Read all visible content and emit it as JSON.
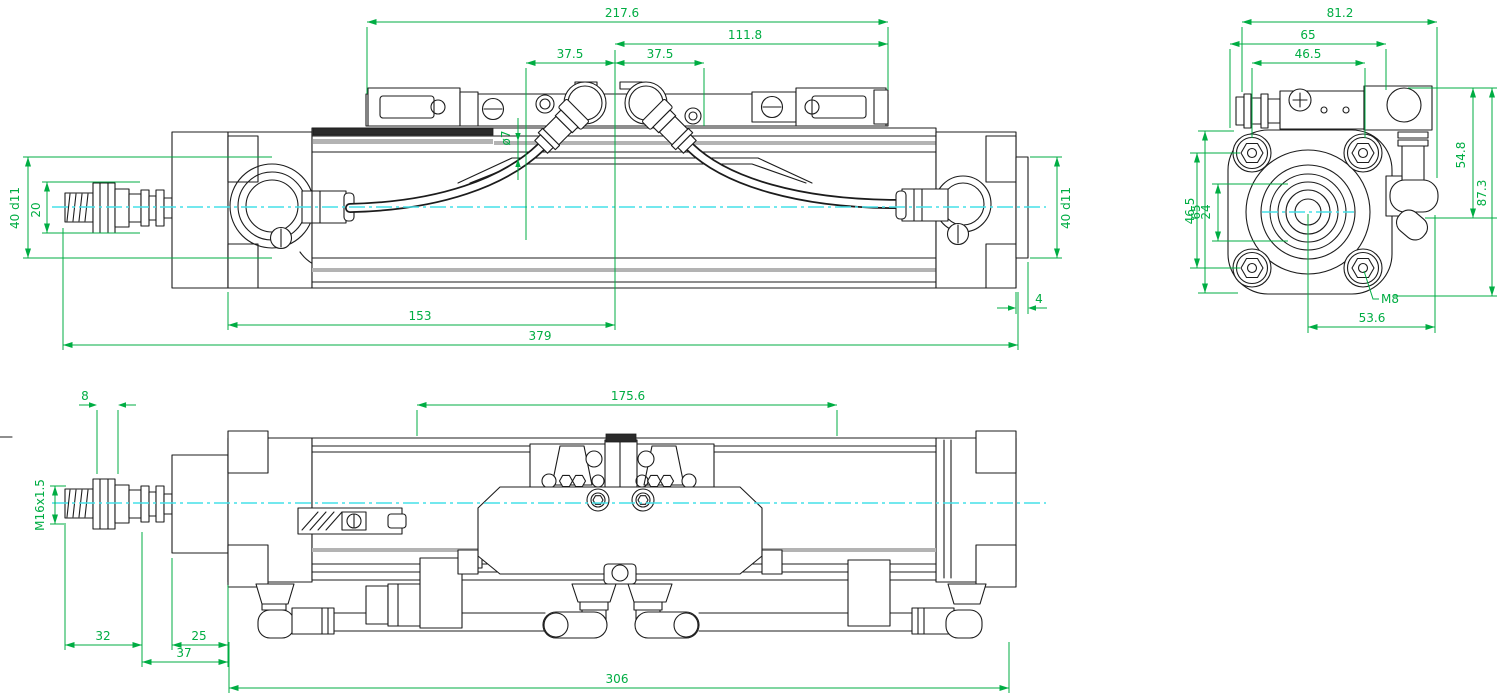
{
  "colors": {
    "dimension_green": "#00ad43",
    "centerline_cyan": "#45e0e8",
    "line_black": "#1c1c1c"
  },
  "views": {
    "side": {
      "dims": {
        "span_ports": "217.6",
        "span_right": "111.8",
        "pitch_left": "37.5",
        "pitch_right": "37.5",
        "hose_od": "ø7",
        "pilot_dia_left": "40 d11",
        "rod_dia": "20",
        "pilot_dia_right": "40 d11",
        "step_width": "4",
        "port_center_dist": "153",
        "overall_length": "379"
      }
    },
    "front": {
      "dims": {
        "overall_width": "81.2",
        "body_width": "65",
        "bolt_pitch_h": "46.5",
        "height_upper": "54.8",
        "overall_height": "87.3",
        "flange_height": "65",
        "bolt_pitch_v": "46.5",
        "hub_width": "24",
        "bolt_thread": "M8",
        "port_center_width": "53.6"
      }
    },
    "top": {
      "dims": {
        "nut_height": "8",
        "body_span": "175.6",
        "rod_thread": "M16x1.5",
        "rod_extension": "32",
        "flange_thickness": "25",
        "flange_total": "37",
        "overall_length": "306"
      }
    }
  }
}
